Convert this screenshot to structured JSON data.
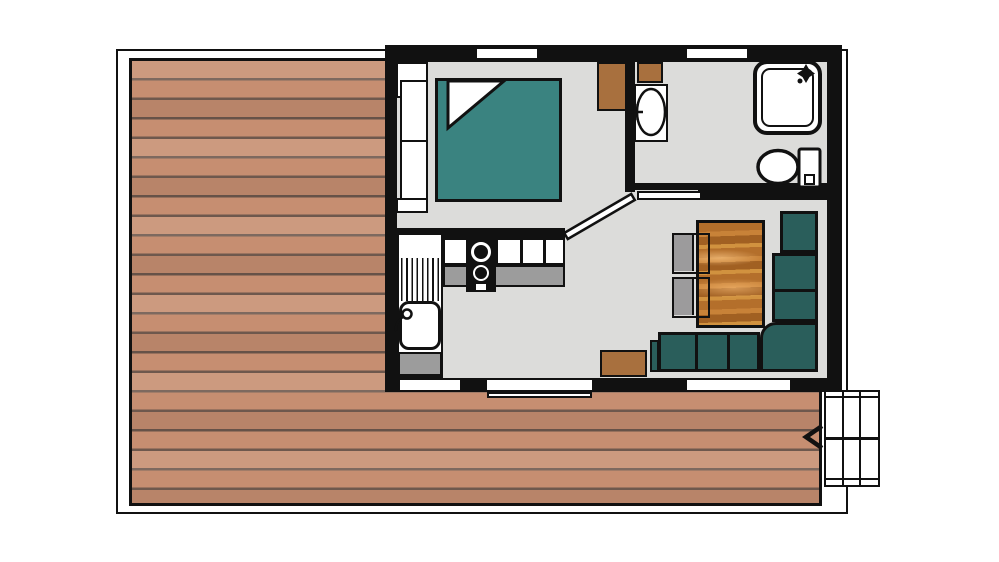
{
  "plan": {
    "kind_label": "floor-plan",
    "rooms": [
      "bedroom",
      "bathroom",
      "hallway",
      "kitchen",
      "living-room",
      "deck",
      "stairs"
    ],
    "furniture": [
      "double-bed",
      "headboard",
      "nightstand",
      "wardrobe",
      "vanity-basin",
      "shower",
      "toilet",
      "kitchen-sink",
      "drainboard",
      "stove-two-burners",
      "kitchen-counter",
      "dining-table",
      "chair",
      "chair",
      "corner-sofa",
      "side-cabinet",
      "sliding-door",
      "windows",
      "exterior-stairs"
    ]
  },
  "icons": {
    "shower_head": "shower-head-star-icon",
    "stairs_direction": "left-chevron-arrow-icon",
    "vanity_faucet": "plus-cross-faucet-icon",
    "sink_faucet": "round-faucet-icon"
  },
  "colors": {
    "wall": "#111111",
    "floor": "#dcdcda",
    "deck_plank": "#c68e71",
    "deck_gap": "#6e584d",
    "bed": "#3a8380",
    "sofa": "#2a5e5b",
    "cabinet_wood": "#a8703e",
    "table_wood_base": "#b46f2b",
    "table_wood_light": "#c88238",
    "table_wood_dark": "#a16022",
    "table_wood_light2": "#d1923f",
    "counter": "#9c9c9c",
    "chair": "#9c9b9c",
    "white": "#ffffff"
  }
}
